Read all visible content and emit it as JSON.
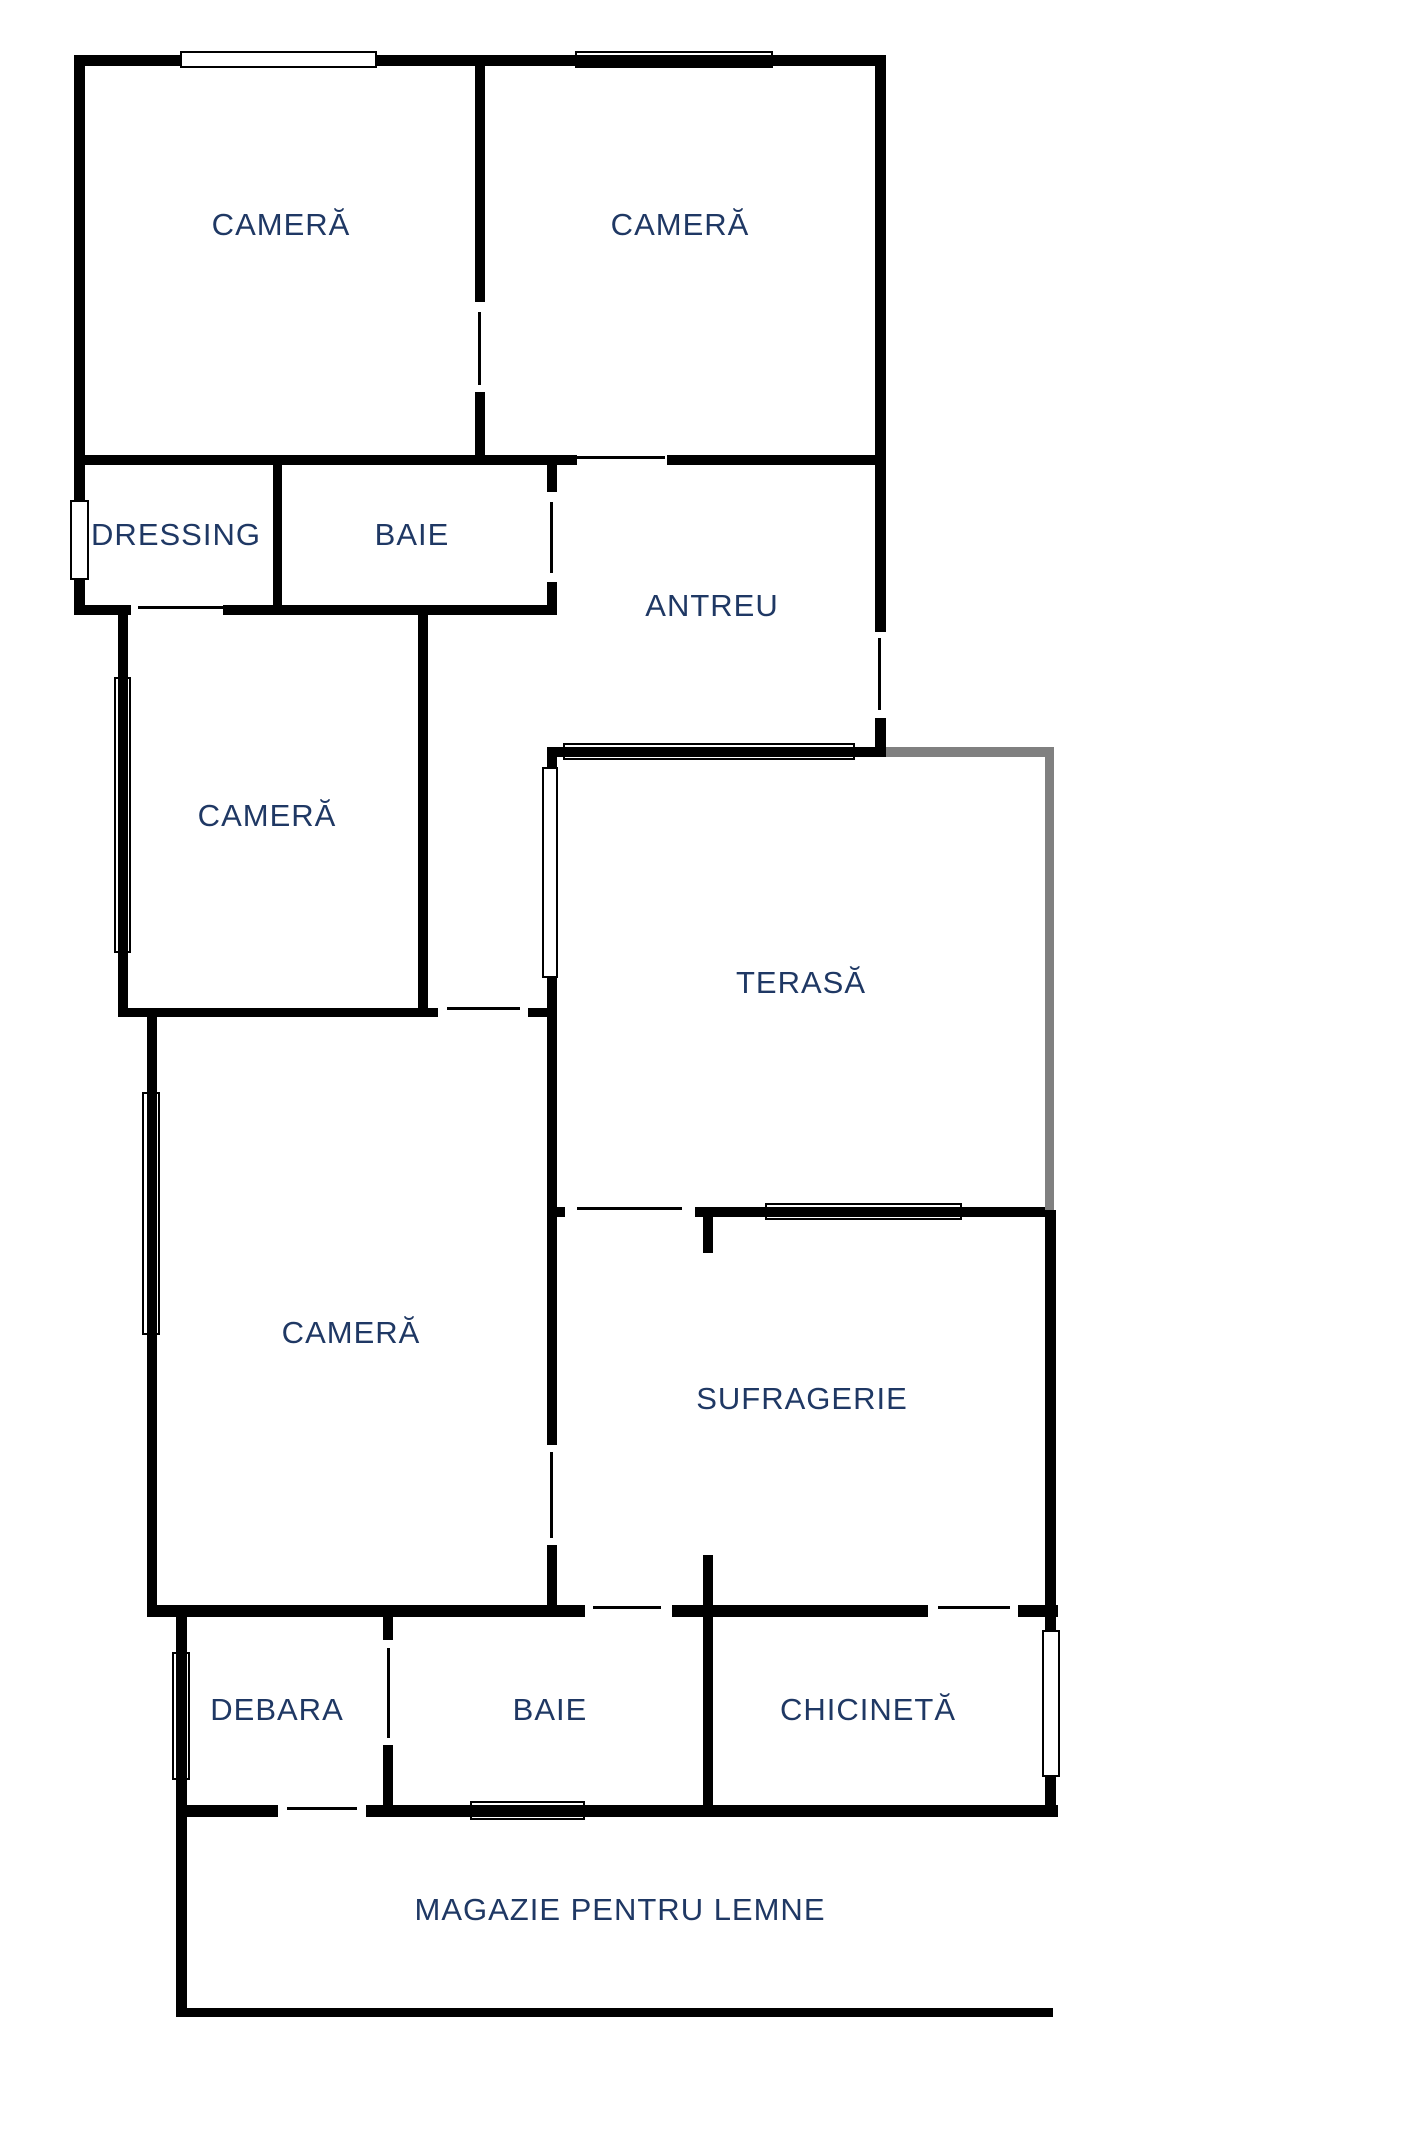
{
  "title": "Floor plan",
  "colors": {
    "background": "#ffffff",
    "wall": "#000000",
    "terrace_wall_gray": "#808080",
    "label_text": "#1f3864"
  },
  "floorplan": {
    "rooms": [
      {
        "id": "camera-1",
        "label": "CAMERĂ",
        "cx": 281,
        "cy": 225
      },
      {
        "id": "camera-2",
        "label": "CAMERĂ",
        "cx": 680,
        "cy": 225
      },
      {
        "id": "dressing",
        "label": "DRESSING",
        "cx": 176,
        "cy": 535
      },
      {
        "id": "baie-1",
        "label": "BAIE",
        "cx": 412,
        "cy": 535
      },
      {
        "id": "antreu",
        "label": "ANTREU",
        "cx": 712,
        "cy": 606
      },
      {
        "id": "camera-3",
        "label": "CAMERĂ",
        "cx": 267,
        "cy": 816
      },
      {
        "id": "terasa",
        "label": "TERASĂ",
        "cx": 801,
        "cy": 983
      },
      {
        "id": "camera-4",
        "label": "CAMERĂ",
        "cx": 351,
        "cy": 1333
      },
      {
        "id": "sufragerie",
        "label": "SUFRAGERIE",
        "cx": 802,
        "cy": 1399
      },
      {
        "id": "debara",
        "label": "DEBARA",
        "cx": 277,
        "cy": 1710
      },
      {
        "id": "baie-2",
        "label": "BAIE",
        "cx": 550,
        "cy": 1710
      },
      {
        "id": "chicineta",
        "label": "CHICINETĂ",
        "cx": 868,
        "cy": 1710
      },
      {
        "id": "magazie",
        "label": "MAGAZIE PENTRU LEMNE",
        "cx": 620,
        "cy": 1910
      }
    ],
    "walls": [
      {
        "id": "top-outer",
        "x": 74,
        "y": 55,
        "w": 812,
        "h": 11,
        "color": "wall"
      },
      {
        "id": "mid1-left",
        "x": 74,
        "y": 455,
        "w": 503,
        "h": 10,
        "color": "wall"
      },
      {
        "id": "mid1-right",
        "x": 667,
        "y": 455,
        "w": 219,
        "h": 10,
        "color": "wall"
      },
      {
        "id": "dressing-bottom-left",
        "x": 74,
        "y": 605,
        "w": 57,
        "h": 10,
        "color": "wall"
      },
      {
        "id": "dressing-bottom-right",
        "x": 223,
        "y": 605,
        "w": 334,
        "h": 10,
        "color": "wall"
      },
      {
        "id": "camera3-bottom-left",
        "x": 118,
        "y": 1008,
        "w": 320,
        "h": 9,
        "color": "wall"
      },
      {
        "id": "camera3-bottom-right",
        "x": 528,
        "y": 1008,
        "w": 29,
        "h": 9,
        "color": "wall"
      },
      {
        "id": "terasa-top-black",
        "x": 547,
        "y": 747,
        "w": 328,
        "h": 10,
        "color": "wall"
      },
      {
        "id": "terasa-top-gray",
        "x": 875,
        "y": 747,
        "w": 179,
        "h": 10,
        "color": "gray"
      },
      {
        "id": "terasa-bottom-stub",
        "x": 555,
        "y": 1207,
        "w": 10,
        "h": 10,
        "color": "wall"
      },
      {
        "id": "sufragerie-top",
        "x": 695,
        "y": 1207,
        "w": 358,
        "h": 10,
        "color": "wall"
      },
      {
        "id": "bottomrow-top-left",
        "x": 147,
        "y": 1605,
        "w": 438,
        "h": 12,
        "color": "wall"
      },
      {
        "id": "bottomrow-top-mid",
        "x": 672,
        "y": 1605,
        "w": 256,
        "h": 12,
        "color": "wall"
      },
      {
        "id": "bottomrow-top-right",
        "x": 1018,
        "y": 1605,
        "w": 40,
        "h": 12,
        "color": "wall"
      },
      {
        "id": "magazie-top-left",
        "x": 176,
        "y": 1805,
        "w": 102,
        "h": 12,
        "color": "wall"
      },
      {
        "id": "magazie-top-right",
        "x": 366,
        "y": 1805,
        "w": 692,
        "h": 12,
        "color": "wall"
      },
      {
        "id": "magazie-bottom",
        "x": 176,
        "y": 2008,
        "w": 877,
        "h": 9,
        "color": "wall"
      },
      {
        "id": "left-outer-top",
        "x": 74,
        "y": 55,
        "w": 11,
        "h": 560,
        "color": "wall"
      },
      {
        "id": "top-divider-upper",
        "x": 475,
        "y": 55,
        "w": 10,
        "h": 247,
        "color": "wall"
      },
      {
        "id": "top-divider-lower",
        "x": 475,
        "y": 392,
        "w": 10,
        "h": 73,
        "color": "wall"
      },
      {
        "id": "right-outer-upper",
        "x": 875,
        "y": 55,
        "w": 11,
        "h": 577,
        "color": "wall"
      },
      {
        "id": "right-outer-lower",
        "x": 875,
        "y": 718,
        "w": 11,
        "h": 39,
        "color": "wall"
      },
      {
        "id": "dressing-baie-divider",
        "x": 273,
        "y": 465,
        "w": 9,
        "h": 150,
        "color": "wall"
      },
      {
        "id": "baie1-right-upper",
        "x": 547,
        "y": 465,
        "w": 10,
        "h": 27,
        "color": "wall"
      },
      {
        "id": "baie1-right-lower",
        "x": 547,
        "y": 582,
        "w": 10,
        "h": 33,
        "color": "wall"
      },
      {
        "id": "camera3-left",
        "x": 118,
        "y": 615,
        "w": 10,
        "h": 402,
        "color": "wall"
      },
      {
        "id": "camera3-right",
        "x": 418,
        "y": 615,
        "w": 10,
        "h": 393,
        "color": "wall"
      },
      {
        "id": "terasa-left-upper",
        "x": 547,
        "y": 757,
        "w": 10,
        "h": 688,
        "color": "wall"
      },
      {
        "id": "terasa-left-lower",
        "x": 547,
        "y": 1545,
        "w": 10,
        "h": 72,
        "color": "wall"
      },
      {
        "id": "terasa-right-gray",
        "x": 1045,
        "y": 747,
        "w": 9,
        "h": 463,
        "color": "gray"
      },
      {
        "id": "sufragerie-right",
        "x": 1045,
        "y": 1210,
        "w": 11,
        "h": 607,
        "color": "wall"
      },
      {
        "id": "camera4-left",
        "x": 147,
        "y": 1008,
        "w": 10,
        "h": 609,
        "color": "wall"
      },
      {
        "id": "debara-magazie-left",
        "x": 176,
        "y": 1617,
        "w": 11,
        "h": 400,
        "color": "wall"
      },
      {
        "id": "debara-baie-divider-top",
        "x": 383,
        "y": 1617,
        "w": 10,
        "h": 23,
        "color": "wall"
      },
      {
        "id": "debara-baie-divider-bot",
        "x": 383,
        "y": 1745,
        "w": 10,
        "h": 62,
        "color": "wall"
      },
      {
        "id": "sufragerie-stub",
        "x": 703,
        "y": 1217,
        "w": 10,
        "h": 36,
        "color": "wall"
      },
      {
        "id": "baie2-chicineta-divider",
        "x": 703,
        "y": 1555,
        "w": 10,
        "h": 252,
        "color": "wall"
      }
    ],
    "doors": [
      {
        "id": "door-camera1-camera2",
        "x": 478,
        "y": 312,
        "w": 3,
        "h": 73
      },
      {
        "id": "door-camera2-antreu",
        "x": 577,
        "y": 456,
        "w": 88,
        "h": 3
      },
      {
        "id": "door-baie1-antreu",
        "x": 550,
        "y": 502,
        "w": 3,
        "h": 71
      },
      {
        "id": "door-antreu-exterior",
        "x": 878,
        "y": 638,
        "w": 3,
        "h": 72
      },
      {
        "id": "door-dressing-camera3",
        "x": 138,
        "y": 606,
        "w": 85,
        "h": 3
      },
      {
        "id": "door-camera4-hall",
        "x": 447,
        "y": 1007,
        "w": 73,
        "h": 3
      },
      {
        "id": "door-terasa-sufragerie",
        "x": 577,
        "y": 1207,
        "w": 105,
        "h": 3
      },
      {
        "id": "door-camera4-sufragerie",
        "x": 550,
        "y": 1452,
        "w": 3,
        "h": 86
      },
      {
        "id": "door-sufragerie-baie2",
        "x": 593,
        "y": 1606,
        "w": 68,
        "h": 3
      },
      {
        "id": "door-sufragerie-chicineta",
        "x": 938,
        "y": 1606,
        "w": 72,
        "h": 3
      },
      {
        "id": "door-debara-baie2",
        "x": 387,
        "y": 1648,
        "w": 3,
        "h": 90
      },
      {
        "id": "door-debara-magazie",
        "x": 287,
        "y": 1807,
        "w": 70,
        "h": 3
      }
    ],
    "windows": [
      {
        "id": "window-camera1-top",
        "x": 180,
        "y": 51,
        "w": 197,
        "h": 17,
        "style": "opaque"
      },
      {
        "id": "window-camera2-top",
        "x": 575,
        "y": 51,
        "w": 198,
        "h": 17,
        "style": "overlay"
      },
      {
        "id": "window-dressing-left",
        "x": 70,
        "y": 500,
        "w": 19,
        "h": 80,
        "style": "opaque"
      },
      {
        "id": "window-camera3-left",
        "x": 114,
        "y": 677,
        "w": 17,
        "h": 276,
        "style": "overlay"
      },
      {
        "id": "window-terasa-left",
        "x": 542,
        "y": 767,
        "w": 16,
        "h": 211,
        "style": "opaque"
      },
      {
        "id": "window-terasa-top",
        "x": 563,
        "y": 743,
        "w": 292,
        "h": 17,
        "style": "overlay"
      },
      {
        "id": "window-terasa-bottom",
        "x": 765,
        "y": 1203,
        "w": 197,
        "h": 17,
        "style": "overlay"
      },
      {
        "id": "window-camera4-left",
        "x": 142,
        "y": 1092,
        "w": 18,
        "h": 243,
        "style": "overlay"
      },
      {
        "id": "window-debara-left",
        "x": 172,
        "y": 1652,
        "w": 18,
        "h": 128,
        "style": "overlay"
      },
      {
        "id": "window-chicineta-right",
        "x": 1042,
        "y": 1630,
        "w": 18,
        "h": 147,
        "style": "opaque"
      },
      {
        "id": "window-magazie-top",
        "x": 470,
        "y": 1801,
        "w": 115,
        "h": 19,
        "style": "overlay"
      }
    ]
  }
}
